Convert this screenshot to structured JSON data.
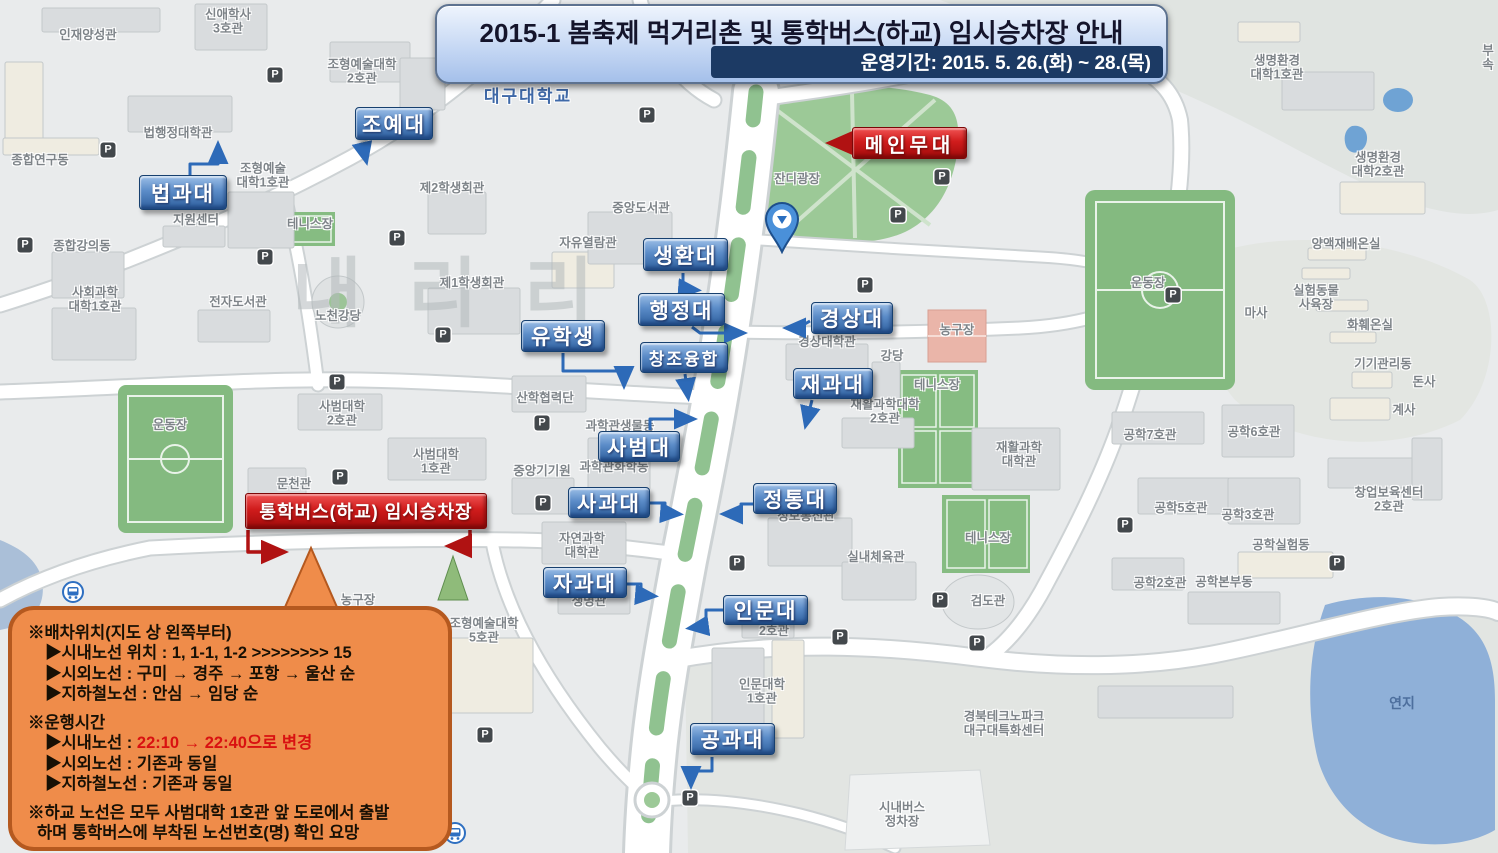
{
  "banner": {
    "title": "2015-1 봄축제 먹거리촌 및 통학버스(하교) 임시승차장 안내",
    "period": "운영기간: 2015. 5. 26.(화) ~ 28.(목)"
  },
  "annotations": {
    "main_stage": "메인무대",
    "bus_stop": "통학버스(하교) 임시승차장",
    "college_labels": [
      {
        "t": "조예대",
        "x": 355,
        "y": 107,
        "w": 78,
        "h": 33
      },
      {
        "t": "법과대",
        "x": 139,
        "y": 175,
        "w": 88,
        "h": 35
      },
      {
        "t": "생환대",
        "x": 643,
        "y": 238,
        "w": 85,
        "h": 33
      },
      {
        "t": "행정대",
        "x": 638,
        "y": 293,
        "w": 87,
        "h": 33
      },
      {
        "t": "유학생",
        "x": 521,
        "y": 320,
        "w": 84,
        "h": 32
      },
      {
        "t": "창조융합",
        "x": 640,
        "y": 342,
        "w": 88,
        "h": 31,
        "fs": 17
      },
      {
        "t": "경상대",
        "x": 811,
        "y": 302,
        "w": 82,
        "h": 32
      },
      {
        "t": "재과대",
        "x": 793,
        "y": 368,
        "w": 80,
        "h": 31
      },
      {
        "t": "사범대",
        "x": 598,
        "y": 431,
        "w": 82,
        "h": 31
      },
      {
        "t": "사과대",
        "x": 568,
        "y": 487,
        "w": 82,
        "h": 31
      },
      {
        "t": "정통대",
        "x": 753,
        "y": 483,
        "w": 84,
        "h": 31
      },
      {
        "t": "자과대",
        "x": 543,
        "y": 567,
        "w": 84,
        "h": 31
      },
      {
        "t": "인문대",
        "x": 723,
        "y": 595,
        "w": 85,
        "h": 30
      },
      {
        "t": "공과대",
        "x": 690,
        "y": 723,
        "w": 85,
        "h": 32
      }
    ]
  },
  "callout": {
    "lines": [
      {
        "t": "※배차위치(지도 상 왼쪽부터)",
        "ind": 0
      },
      {
        "t": "▶시내노선 위치 : 1, 1-1, 1-2 >>>>>>>> 15",
        "ind": 1
      },
      {
        "t": "▶시외노선 : 구미 → 경주 → 포항 → 울산 순",
        "ind": 1
      },
      {
        "t": "▶지하철노선 : 안심 → 임당 순",
        "ind": 1,
        "gap": true
      },
      {
        "t": "※운행시간",
        "ind": 0
      },
      {
        "parts": [
          {
            "t": "▶시내노선 : "
          },
          {
            "t": "22:10 → 22:40으로 변경",
            "red": true
          }
        ],
        "ind": 1
      },
      {
        "t": "▶시외노선 : 기존과 동일",
        "ind": 1
      },
      {
        "t": "▶지하철노선 : 기존과 동일",
        "ind": 1,
        "gap": true
      },
      {
        "t": "※하교 노선은 모두 사범대학 1호관 앞 도로에서 출발",
        "ind": 0
      },
      {
        "t": "하며 통학버스에 부착된 노선번호(명) 확인 요망",
        "ind": 0.5
      }
    ]
  },
  "map": {
    "watermark": "내리리",
    "parking_icon_glyph": "P",
    "labels": [
      {
        "t": "인재양성관",
        "x": 88,
        "y": 35
      },
      {
        "t": "신애학사\n3호관",
        "x": 228,
        "y": 22
      },
      {
        "t": "조형예술대학\n2호관",
        "x": 362,
        "y": 72
      },
      {
        "t": "대구대학교",
        "x": 528,
        "y": 97,
        "cls": "campus"
      },
      {
        "t": "종합연구동",
        "x": 40,
        "y": 160
      },
      {
        "t": "법행정대학관",
        "x": 178,
        "y": 133
      },
      {
        "t": "조형예술\n대학1호관",
        "x": 263,
        "y": 176
      },
      {
        "t": "지원센터",
        "x": 196,
        "y": 220
      },
      {
        "t": "제2학생회관",
        "x": 452,
        "y": 188
      },
      {
        "t": "테니스장",
        "x": 310,
        "y": 224
      },
      {
        "t": "종합강의동",
        "x": 82,
        "y": 246
      },
      {
        "t": "사회과학\n대학1호관",
        "x": 95,
        "y": 300
      },
      {
        "t": "전자도서관",
        "x": 238,
        "y": 302
      },
      {
        "t": "노천강당",
        "x": 338,
        "y": 316
      },
      {
        "t": "제1학생회관",
        "x": 472,
        "y": 283
      },
      {
        "t": "자유열람관",
        "x": 588,
        "y": 243
      },
      {
        "t": "중앙도서관",
        "x": 641,
        "y": 208
      },
      {
        "t": "잔디광장",
        "x": 797,
        "y": 179
      },
      {
        "t": "경상대학관",
        "x": 827,
        "y": 342
      },
      {
        "t": "강당",
        "x": 892,
        "y": 356
      },
      {
        "t": "농구장",
        "x": 957,
        "y": 330
      },
      {
        "t": "테니스장",
        "x": 937,
        "y": 385
      },
      {
        "t": "테니스장",
        "x": 988,
        "y": 538
      },
      {
        "t": "재활과학대학\n2호관",
        "x": 885,
        "y": 412
      },
      {
        "t": "재활과학\n대학관",
        "x": 1019,
        "y": 455
      },
      {
        "t": "운동장",
        "x": 1148,
        "y": 283
      },
      {
        "t": "운동장",
        "x": 170,
        "y": 425
      },
      {
        "t": "문천관",
        "x": 294,
        "y": 484
      },
      {
        "t": "사범대학\n2호관",
        "x": 342,
        "y": 414
      },
      {
        "t": "사범대학\n1호관",
        "x": 436,
        "y": 462
      },
      {
        "t": "산학협력단",
        "x": 545,
        "y": 398
      },
      {
        "t": "중앙기기원",
        "x": 542,
        "y": 471
      },
      {
        "t": "과학관생물동",
        "x": 620,
        "y": 426
      },
      {
        "t": "과학관화학동",
        "x": 614,
        "y": 467
      },
      {
        "t": "자연과학\n대학관",
        "x": 582,
        "y": 546
      },
      {
        "t": "생명관",
        "x": 589,
        "y": 601
      },
      {
        "t": "조형예술대학\n5호관",
        "x": 484,
        "y": 631
      },
      {
        "t": "정보통신관",
        "x": 806,
        "y": 516
      },
      {
        "t": "실내체육관",
        "x": 876,
        "y": 557
      },
      {
        "t": "검도관",
        "x": 988,
        "y": 601
      },
      {
        "t": "2호관",
        "x": 774,
        "y": 631
      },
      {
        "t": "인문대학\n1호관",
        "x": 762,
        "y": 692
      },
      {
        "t": "경북테크노파크\n대구대특화센터",
        "x": 1004,
        "y": 724
      },
      {
        "t": "시내버스\n정차장",
        "x": 902,
        "y": 815
      },
      {
        "t": "연지",
        "x": 1402,
        "y": 703,
        "cls": "water"
      },
      {
        "t": "농구장",
        "x": 358,
        "y": 600
      },
      {
        "t": "생명환경\n대학1호관",
        "x": 1277,
        "y": 68
      },
      {
        "t": "생명환경\n대학2호관",
        "x": 1378,
        "y": 165
      },
      {
        "t": "부속",
        "x": 1488,
        "y": 58
      },
      {
        "t": "양액재배온실",
        "x": 1346,
        "y": 244
      },
      {
        "t": "실험동물\n사육장",
        "x": 1316,
        "y": 298
      },
      {
        "t": "화훼온실",
        "x": 1370,
        "y": 325
      },
      {
        "t": "기기관리동",
        "x": 1383,
        "y": 364
      },
      {
        "t": "마사",
        "x": 1256,
        "y": 313
      },
      {
        "t": "돈사",
        "x": 1424,
        "y": 382
      },
      {
        "t": "계사",
        "x": 1404,
        "y": 410
      },
      {
        "t": "공학7호관",
        "x": 1150,
        "y": 435
      },
      {
        "t": "공학6호관",
        "x": 1254,
        "y": 432
      },
      {
        "t": "공학5호관",
        "x": 1181,
        "y": 508
      },
      {
        "t": "공학3호관",
        "x": 1248,
        "y": 515
      },
      {
        "t": "창업보육센터\n2호관",
        "x": 1389,
        "y": 500
      },
      {
        "t": "공학실험동",
        "x": 1281,
        "y": 545
      },
      {
        "t": "공학2호관",
        "x": 1160,
        "y": 583
      },
      {
        "t": "공학본부동",
        "x": 1224,
        "y": 582
      }
    ],
    "parking_icon_positions": [
      [
        275,
        75
      ],
      [
        647,
        115
      ],
      [
        942,
        177
      ],
      [
        898,
        215
      ],
      [
        108,
        150
      ],
      [
        25,
        245
      ],
      [
        265,
        257
      ],
      [
        397,
        238
      ],
      [
        443,
        335
      ],
      [
        337,
        382
      ],
      [
        865,
        285
      ],
      [
        1173,
        295
      ],
      [
        340,
        477
      ],
      [
        542,
        423
      ],
      [
        543,
        503
      ],
      [
        737,
        563
      ],
      [
        940,
        600
      ],
      [
        840,
        637
      ],
      [
        977,
        643
      ],
      [
        690,
        798
      ],
      [
        1125,
        525
      ],
      [
        1337,
        563
      ],
      [
        485,
        735
      ]
    ],
    "transit_icon_positions": [
      [
        73,
        592
      ],
      [
        455,
        833
      ]
    ]
  },
  "colors": {
    "label_blue": "#2e5f9e",
    "label_blue_border": "#17406f",
    "label_red": "#c01414",
    "label_red_border": "#7c0707",
    "banner_fill": "#c6d8f4",
    "banner_period_bg": "#1c3a64",
    "callout_fill": "#ef8c4a",
    "callout_border": "#b5591f",
    "highlight_red": "#d91111",
    "lawn_green": "#9cc997",
    "field_green": "#84ba80",
    "pond_blue": "#8fb0d8",
    "road_white": "#ffffff"
  }
}
